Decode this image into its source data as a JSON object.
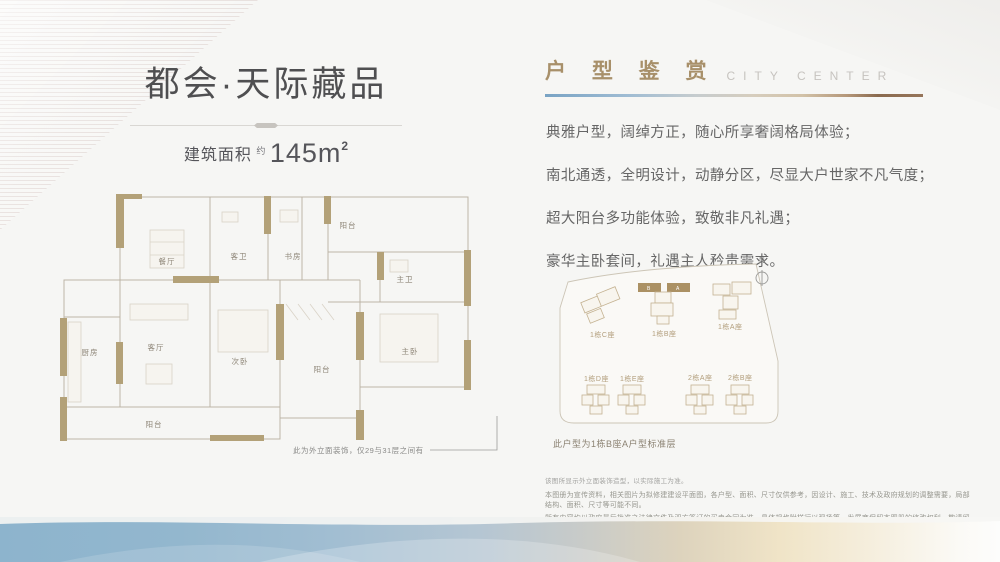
{
  "brand": {
    "title": "都会·天际藏品",
    "area_label": "建筑面积",
    "area_about": "约",
    "area_value": "145m",
    "area_sup": "2"
  },
  "header": {
    "title_cn": "户 型 鉴 赏",
    "title_en": "CITY CENTER"
  },
  "description": {
    "lines": [
      "典雅户型，阔绰方正，随心所享奢阔格局体验；",
      "南北通透，全明设计，动静分区，尽显大户世家不凡气度；",
      "超大阳台多功能体验，致敬非凡礼遇；",
      "豪华主卧套间，礼遇主人矜贵需求。"
    ]
  },
  "floorplan": {
    "rooms": [
      {
        "label": "餐厅"
      },
      {
        "label": "客卫"
      },
      {
        "label": "书房"
      },
      {
        "label": "阳台"
      },
      {
        "label": "主卫"
      },
      {
        "label": "厨房"
      },
      {
        "label": "客厅"
      },
      {
        "label": "次卧"
      },
      {
        "label": "阳台"
      },
      {
        "label": "主卧"
      },
      {
        "label": "阳台"
      }
    ],
    "note": "此为外立面装饰，仅29与31层之间有"
  },
  "siteplan": {
    "compass": "N",
    "buildings": [
      {
        "label": "1栋C座"
      },
      {
        "label": "1栋B座"
      },
      {
        "label": "1栋A座"
      },
      {
        "label": "1栋D座"
      },
      {
        "label": "1栋E座"
      },
      {
        "label": "2栋A座"
      },
      {
        "label": "2栋B座"
      }
    ],
    "unit_b": "B",
    "unit_a": "A",
    "caption": "此户型为1栋B座A户型标准层"
  },
  "disclaimer": {
    "line1": "该图所显示外立面装饰造型，以实际施工为准。",
    "line2": "本图册为宣传资料，相关图片为拟修建建设平面图，各户型、面积、尺寸仅供参考，因设计、施工、技术及政府规划的调整需要，局部结构、面积、尺寸等可能不同。",
    "line3": "所有内容均以政府最后批准之法律文件及双方签订的买卖合同为准，具体规格附样行以现场等，发展商保留本图册的修改权利，敬请留意最新资料。"
  },
  "colors": {
    "accent_gold": "#a8906a",
    "wall_tan": "#b3a178",
    "band_blue": "#8db4cd",
    "band_cream": "#f0e4c7",
    "text_gray": "#666666"
  }
}
